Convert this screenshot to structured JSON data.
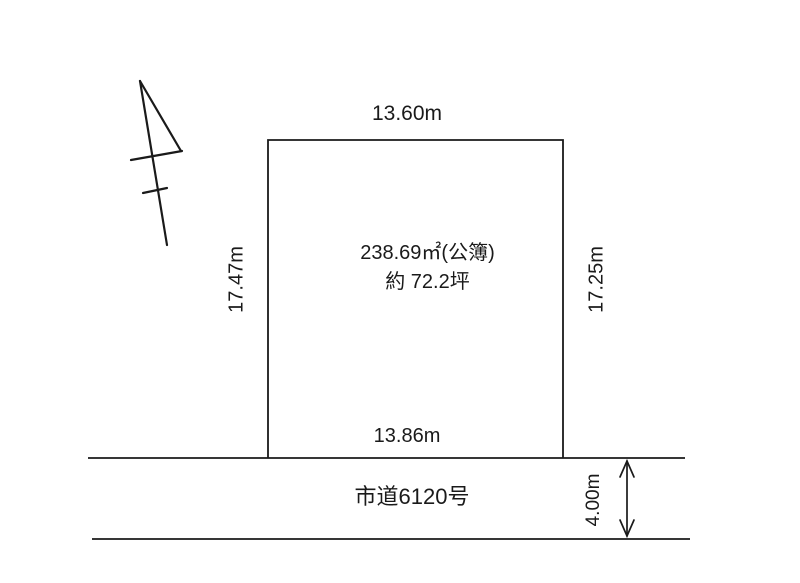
{
  "diagram": {
    "title": "land-lot-diagram",
    "lot": {
      "top_dim": "13.60m",
      "left_dim": "17.47m",
      "right_dim": "17.25m",
      "bottom_dim": "13.86m",
      "area_line1": "238.69㎡(公簿)",
      "area_line2": "約 72.2坪"
    },
    "road": {
      "name": "市道6120号",
      "width_dim": "4.00m"
    },
    "icons": {
      "north_arrow": "north-arrow-icon",
      "road_width_arrow": "double-arrow-icon"
    },
    "colors": {
      "background": "#ffffff",
      "line": "#1a1a1a"
    }
  }
}
